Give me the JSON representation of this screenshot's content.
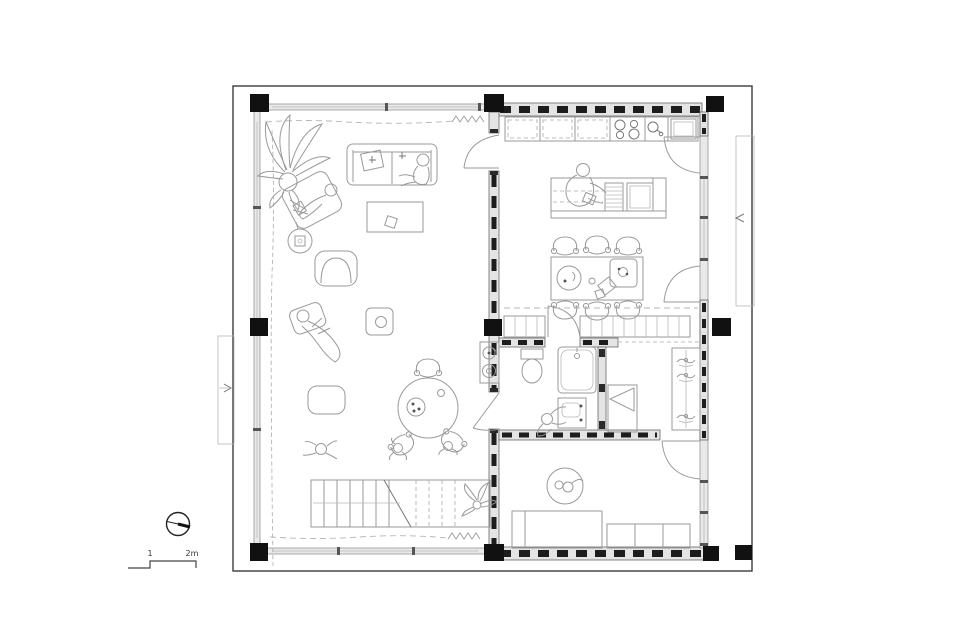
{
  "figure": {
    "type": "architectural-floor-plan",
    "description": "single-storey house plan: open living room with stair (left unit), kitchen-dining, bathroom, bedroom and kids room (right unit)"
  },
  "scale_bar": {
    "tick_1": "1",
    "tick_2": "2m"
  },
  "north_indicator": {
    "icon": "compass-circle-icon"
  },
  "colors": {
    "background": "#ffffff",
    "column_black": "#111111",
    "wall_fill": "#e4e4e4",
    "wall_stud": "#1d1d1d",
    "furniture_line": "#9a9a9a",
    "curtain_line": "#b5b5b5"
  }
}
